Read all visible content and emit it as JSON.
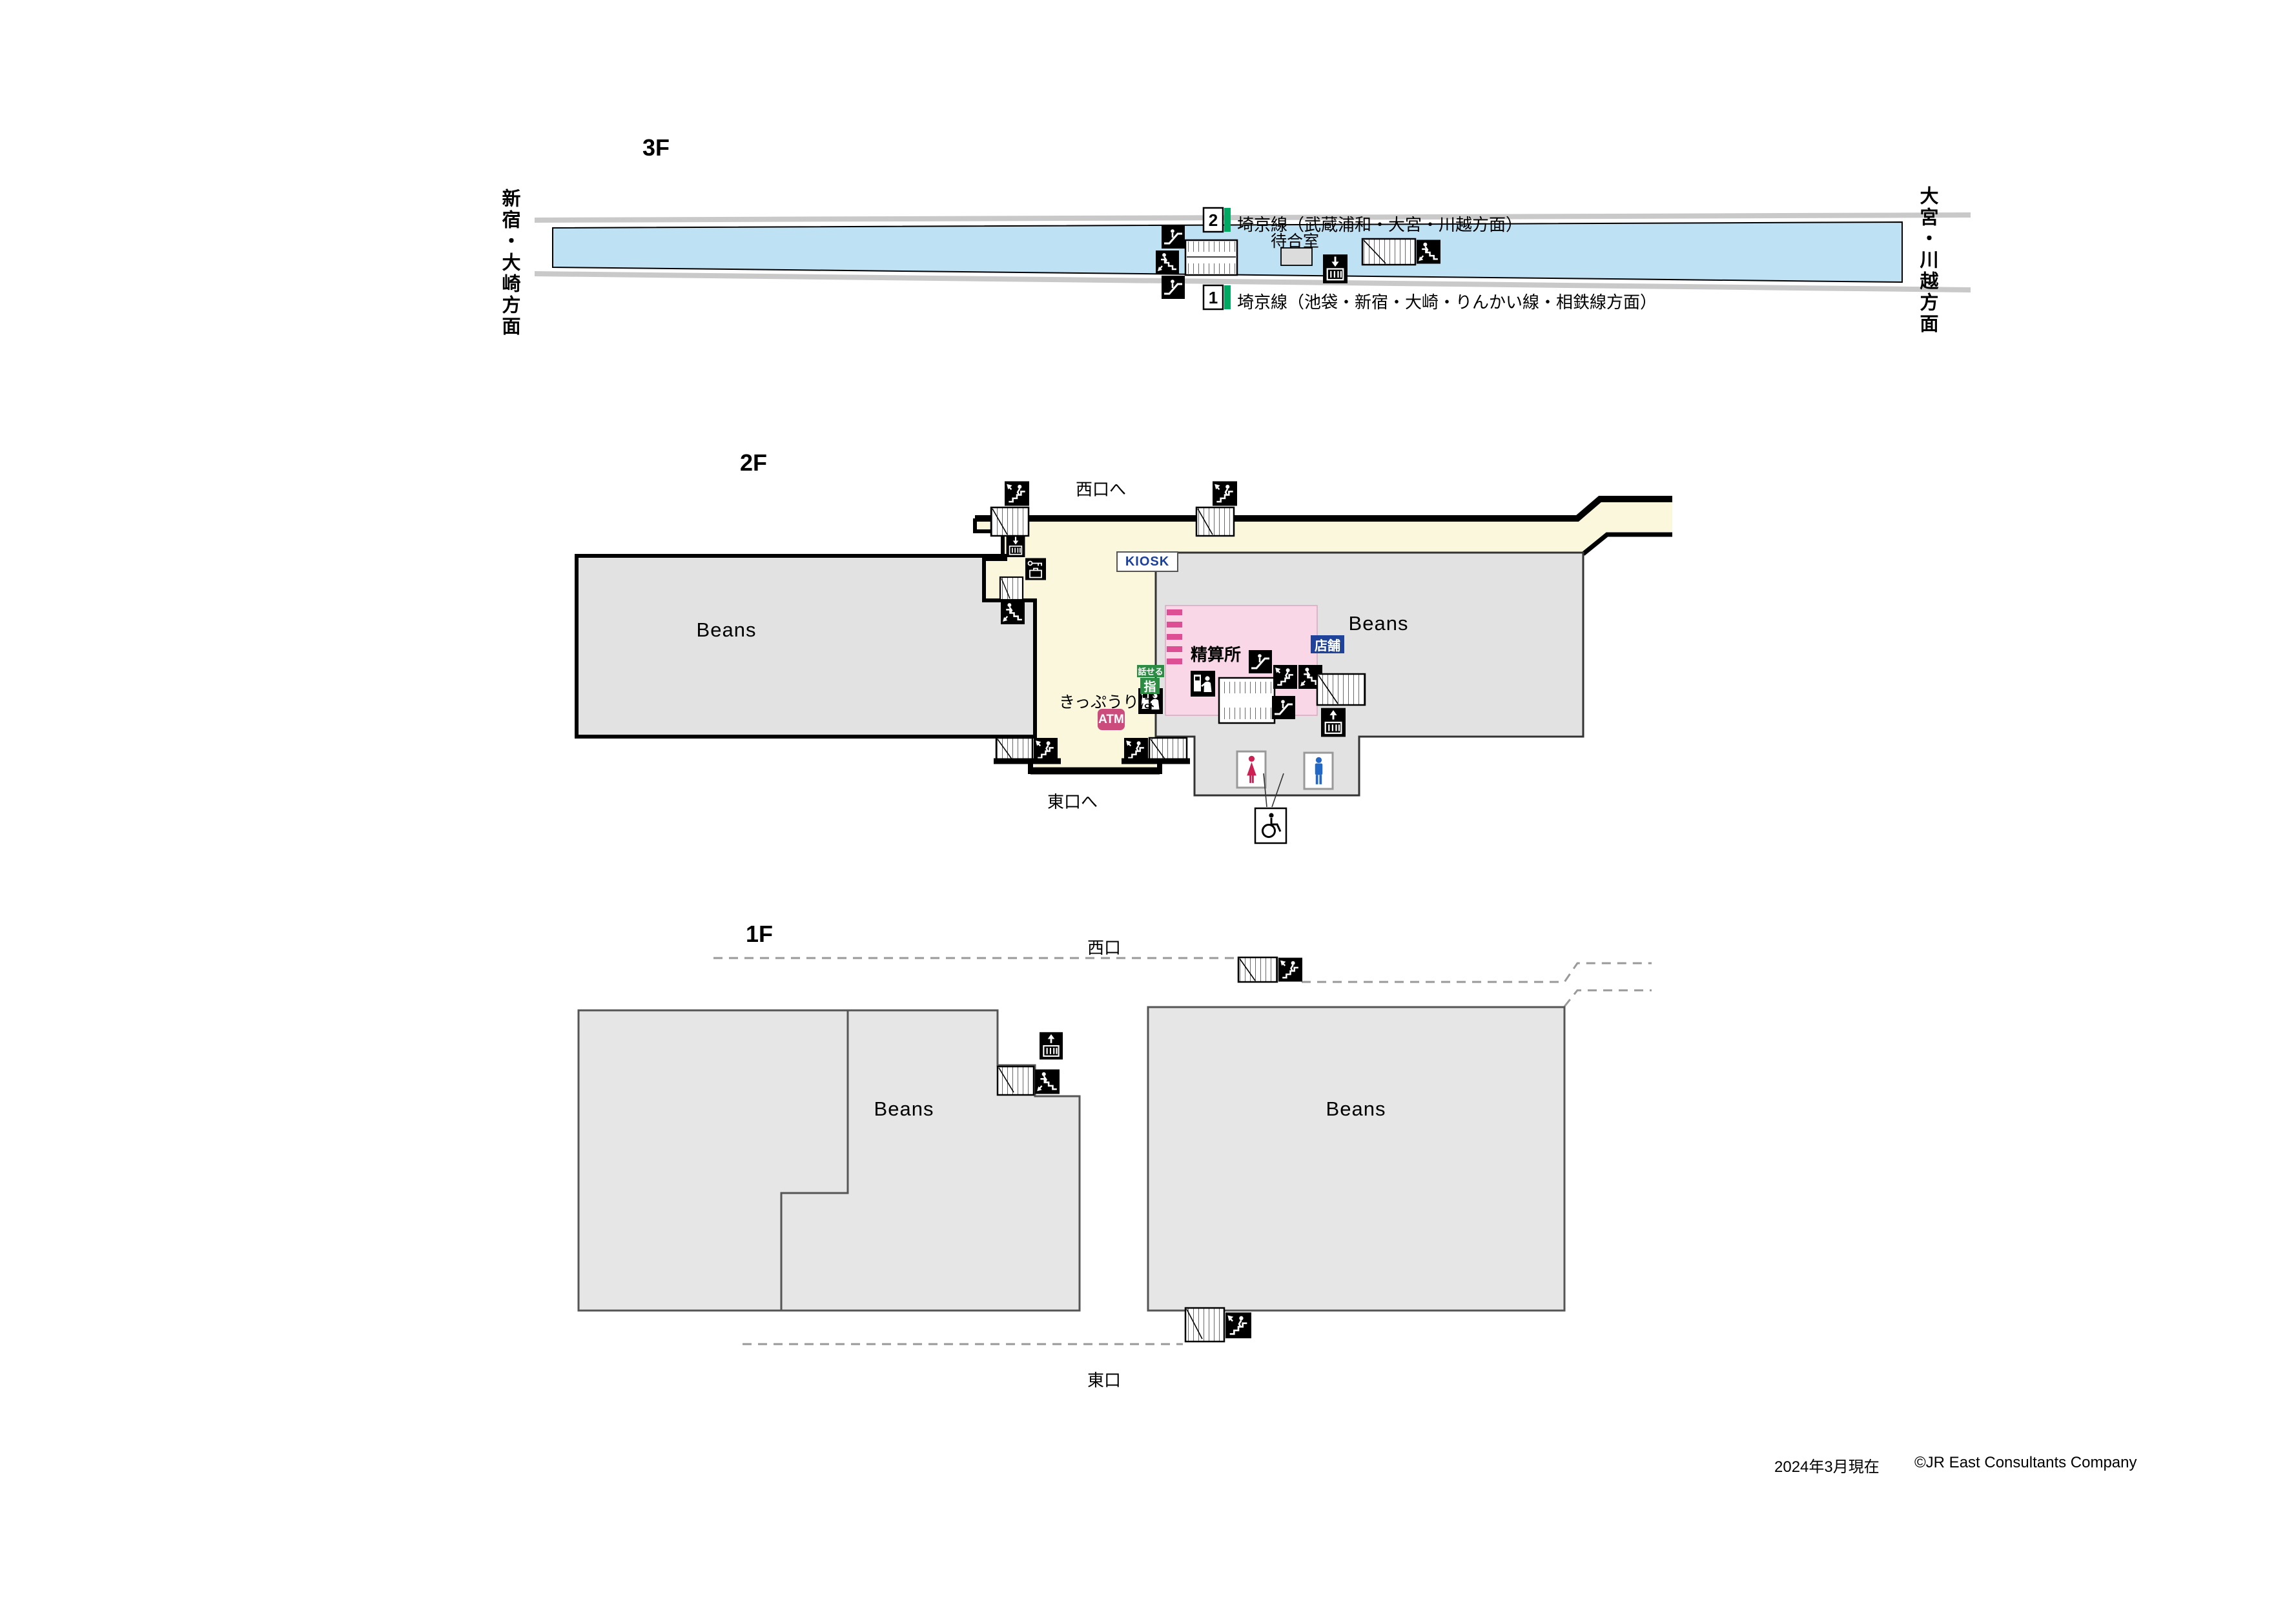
{
  "station_map": {
    "footer": {
      "date": "2024年3月現在",
      "credit": "©JR East Consultants Company"
    },
    "colors": {
      "platform_blue": "#BEE1F4",
      "concourse_yellow": "#FBF7DC",
      "block_gray": "#E2E2E2",
      "saikyo_line_green": "#00A863",
      "fare_area_pink": "#F9D7E7",
      "ticket_gate_magenta": "#DD4E94",
      "atm_magenta": "#CB4B7C",
      "accessible_ticket_green": "#2C8C43",
      "shop_label_blue": "#1F4398",
      "kiosk_text_blue": "#1B3F9E",
      "track_gray": "#C9C9C9"
    },
    "floor3": {
      "label": "3F",
      "direction_left": "新宿・大崎方面",
      "direction_right": "大宮・川越方面",
      "platforms": [
        {
          "number": "2",
          "line_label": "埼京線（武蔵浦和・大宮・川越方面）"
        },
        {
          "number": "1",
          "line_label": "埼京線（池袋・新宿・大崎・りんかい線・相鉄線方面）"
        }
      ],
      "waiting_room_label": "待合室"
    },
    "floor2": {
      "label": "2F",
      "to_west_exit": "西口へ",
      "to_east_exit": "東口へ",
      "kiosk_label": "KIOSK",
      "fare_adjustment_label": "精算所",
      "shop_label": "店舗",
      "ticket_office_label": "きっぷうりば",
      "atm_label": "ATM",
      "talkable_machine_label": "話せる",
      "reserved_seat_label": "指",
      "beans_left": "Beans",
      "beans_right": "Beans"
    },
    "floor1": {
      "label": "1F",
      "west_exit_label": "西口",
      "east_exit_label": "東口",
      "beans_center": "Beans",
      "beans_right": "Beans"
    }
  }
}
